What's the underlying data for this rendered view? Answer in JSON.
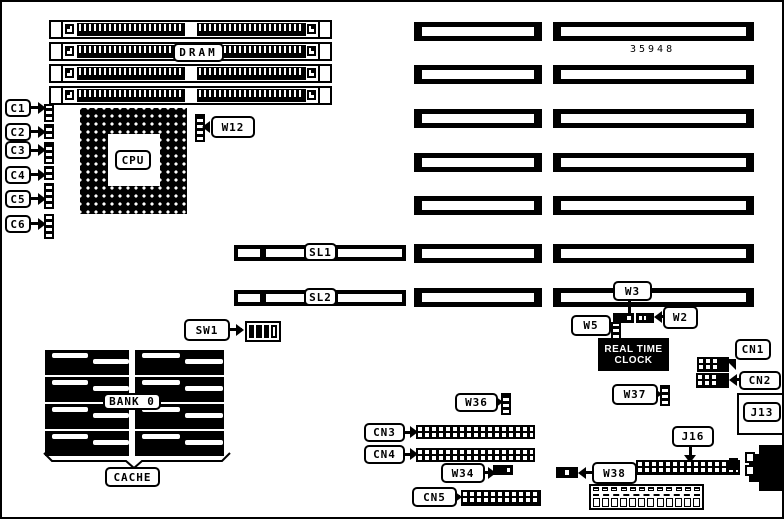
{
  "part_number": "35948",
  "labels": {
    "c1": "C1",
    "c2": "C2",
    "c3": "C3",
    "c4": "C4",
    "c5": "C5",
    "c6": "C6",
    "dram": "DRAM",
    "cpu": "CPU",
    "w12": "W12",
    "sl1": "SL1",
    "sl2": "SL2",
    "sw1": "SW1",
    "bank0": "BANK 0",
    "cache": "CACHE",
    "cn1": "CN1",
    "cn2": "CN2",
    "cn3": "CN3",
    "cn4": "CN4",
    "cn5": "CN5",
    "j13": "J13",
    "j16": "J16",
    "w2": "W2",
    "w3": "W3",
    "w5": "W5",
    "w34": "W34",
    "w36": "W36",
    "w37": "W37",
    "w38": "W38"
  },
  "rtc": {
    "line1": "REAL TIME",
    "line2": "CLOCK"
  },
  "colors": {
    "ink": "#000000",
    "paper": "#ffffff"
  }
}
